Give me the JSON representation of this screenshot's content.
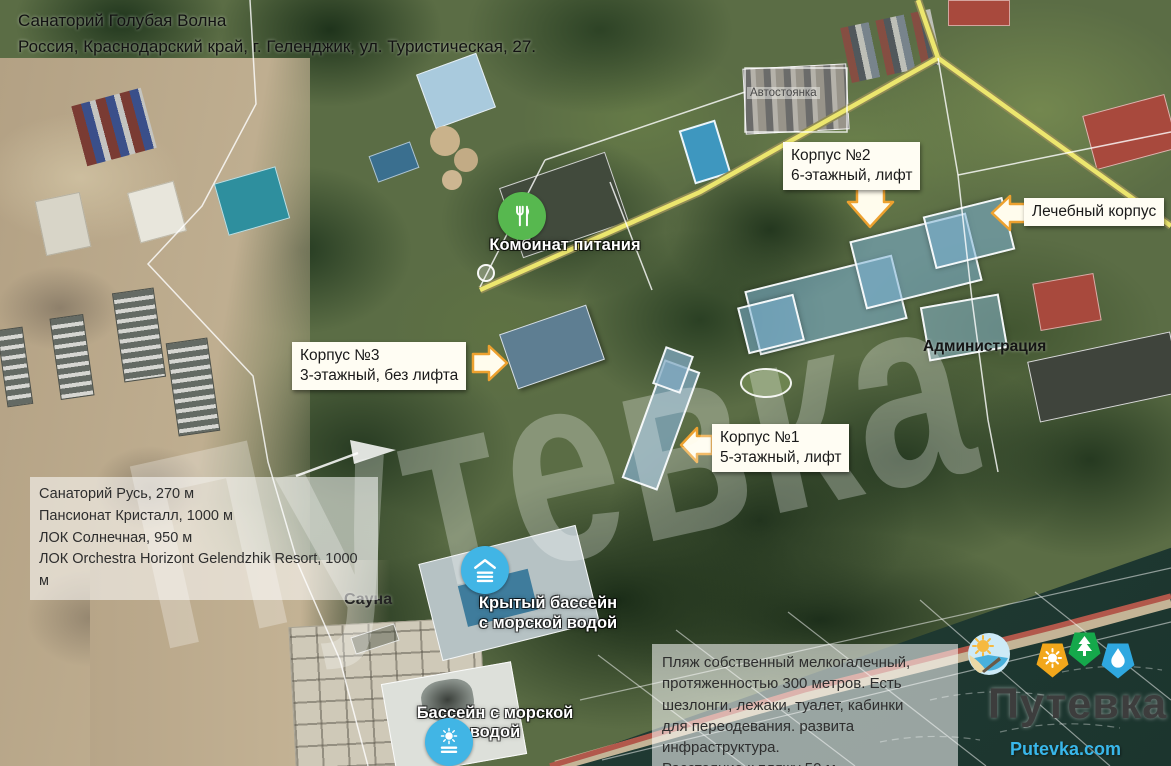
{
  "header": {
    "title": "Санаторий Голубая Волна",
    "address": "Россия, Краснодарский край, г. Геленджик, ул. Туристическая, 27."
  },
  "callouts": {
    "korpus2": {
      "title": "Корпус №2",
      "subtitle": "6-этажный, лифт"
    },
    "medical": {
      "title": "Лечебный корпус"
    },
    "korpus3": {
      "title": "Корпус №3",
      "subtitle": "3-этажный, без лифта"
    },
    "korpus1": {
      "title": "Корпус №1",
      "subtitle": "5-этажный, лифт"
    }
  },
  "map_labels": {
    "parking": "Автостоянка",
    "dining": "Комбинат питания",
    "administration": "Администрация",
    "sauna": "Сауна",
    "indoor_pool_line1": "Крытый бассейн",
    "indoor_pool_line2": "с морской водой",
    "outdoor_pool": "Бассейн с морской водой"
  },
  "nearby_box": {
    "lines": [
      "Санаторий Русь, 270 м",
      "Пансионат Кристалл, 1000 м",
      "ЛОК Солнечная, 950 м",
      "ЛОК Orchestra Horizont Gelendzhik Resort, 1000 м"
    ]
  },
  "beach_box": {
    "lines": [
      "Пляж собственный мелкогалечный,",
      "протяженностью 300 метров. Есть",
      "шезлонги, лежаки, туалет, кабинки",
      "для переодевания. развита инфраструктура.",
      "Расстояние к пляжу 50 м."
    ]
  },
  "branding": {
    "logo": "Путевка",
    "website": "Putevka.com",
    "watermark": "Путевка"
  },
  "colors": {
    "callout_arrow_orange": "#eda12f",
    "callout_bg": "#fffdf3",
    "dining_icon_green": "#57b84f",
    "pool_icon_blue": "#41b5e5",
    "badge_orange": "#f2a71b",
    "badge_green": "#15a84b",
    "badge_blue": "#2fa8e0",
    "logo_text": "#3d3d3d",
    "website_text": "#39b7ea",
    "highlight_building": "#7cb2d6"
  }
}
